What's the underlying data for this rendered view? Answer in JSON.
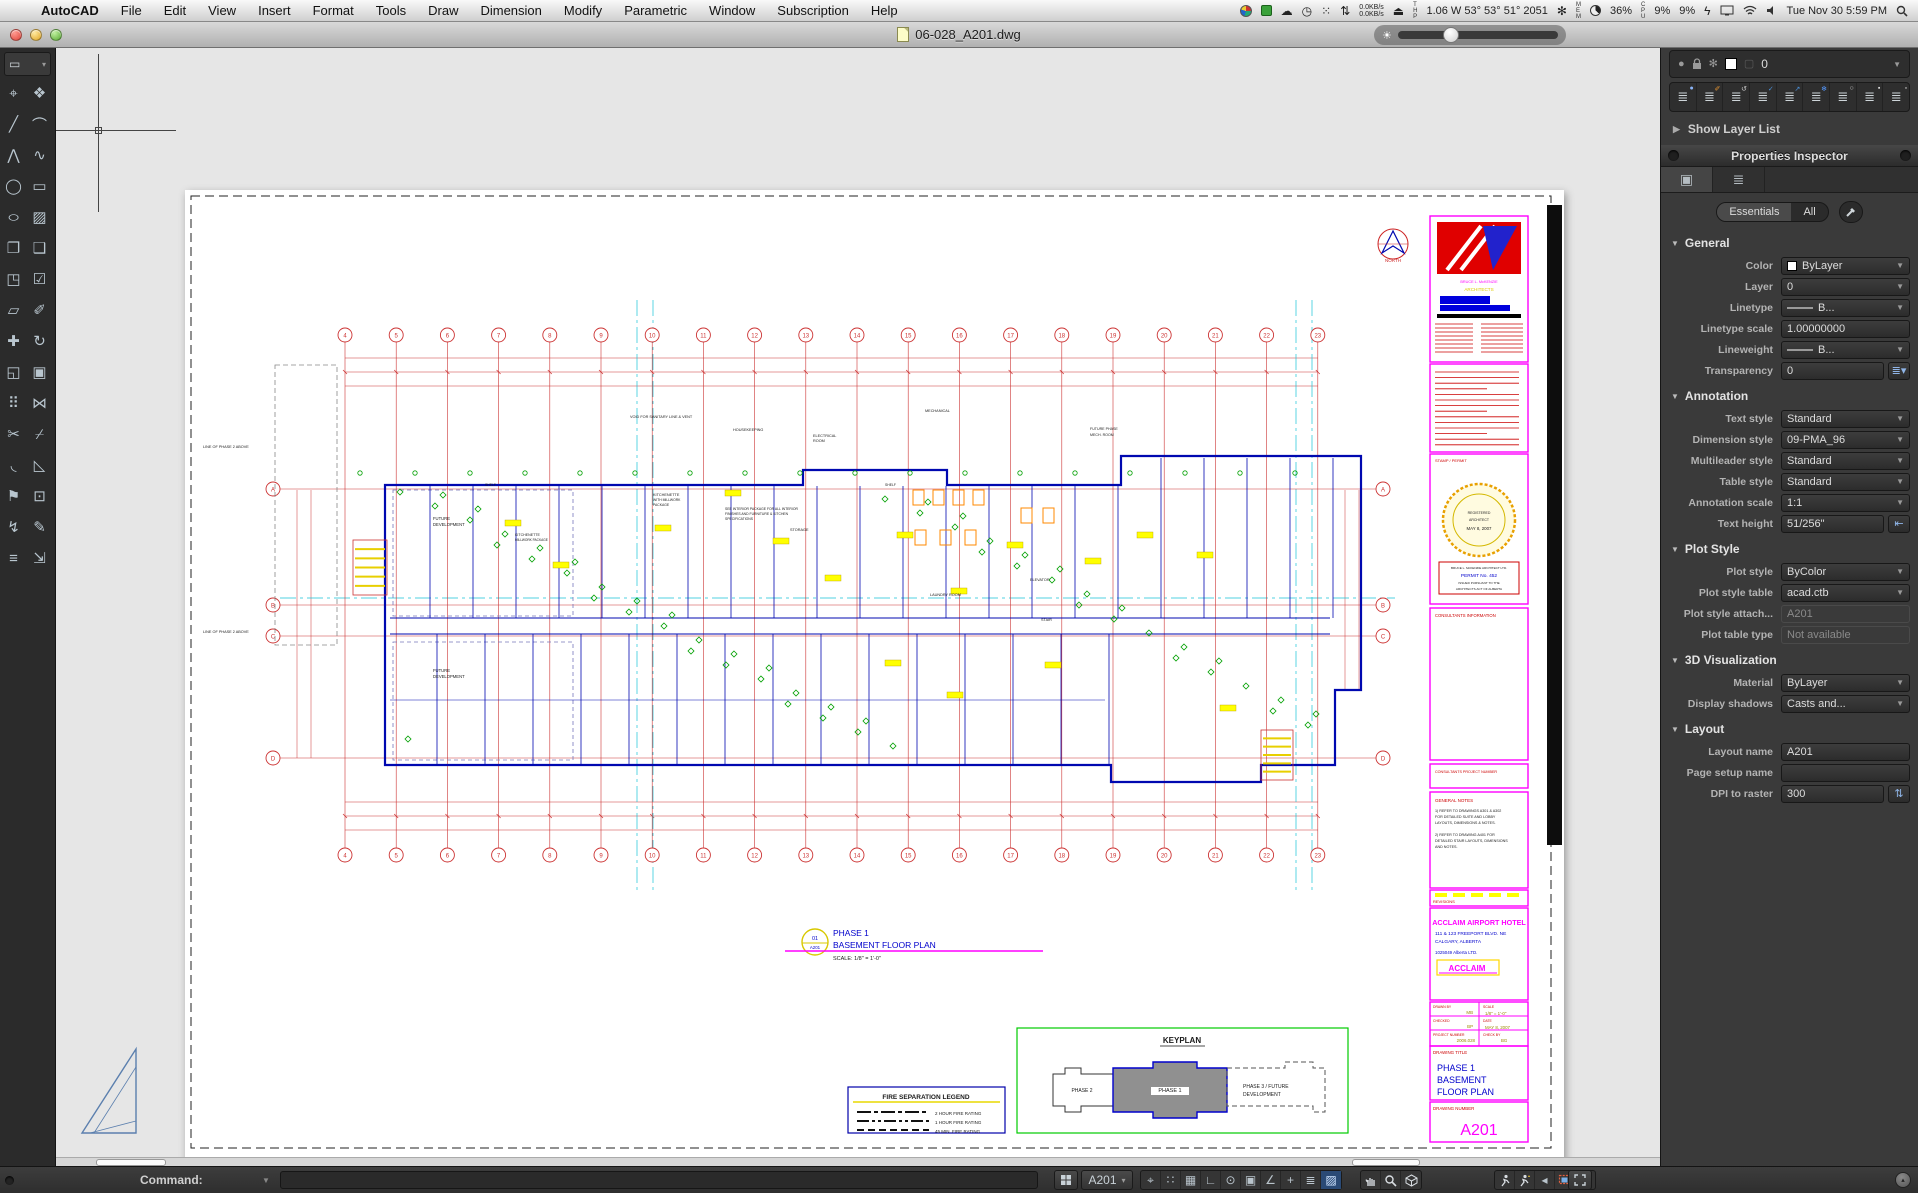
{
  "menu_bar": {
    "apple": "",
    "items": [
      "AutoCAD",
      "File",
      "Edit",
      "View",
      "Insert",
      "Format",
      "Tools",
      "Draw",
      "Dimension",
      "Modify",
      "Parametric",
      "Window",
      "Subscription",
      "Help"
    ],
    "status": {
      "net_up": "0.0KB/s",
      "net_down": "0.0KB/s",
      "sensor_prefix": "THP",
      "sensor_readout": "1.06 W 53° 53° 51° 2051",
      "mem_prefix": "MEM",
      "mem_pct": "36%",
      "cpu_prefix": "CPU",
      "cpu_pct": "9%",
      "gpu_pct": "9%",
      "clock": "Tue Nov 30  5:59 PM"
    }
  },
  "window": {
    "title": "06-028_A201.dwg"
  },
  "tool_palette": {
    "tools": [
      {
        "n": "point-tool",
        "g": "⌖"
      },
      {
        "n": "block-tool",
        "g": "❖"
      },
      {
        "n": "line-tool",
        "g": "╱"
      },
      {
        "n": "arc-tool",
        "g": "⌒"
      },
      {
        "n": "polyline-tool",
        "g": "⋀"
      },
      {
        "n": "spline-tool",
        "g": "∿"
      },
      {
        "n": "circle-tool",
        "g": "◯"
      },
      {
        "n": "rectangle-tool",
        "g": "▭"
      },
      {
        "n": "ellipse-tool",
        "g": "○"
      },
      {
        "n": "hatch-tool",
        "g": "▨"
      },
      {
        "n": "copy-tool",
        "g": "❐"
      },
      {
        "n": "duplicate-tool",
        "g": "❑"
      },
      {
        "n": "stamp-tool",
        "g": "◳"
      },
      {
        "n": "stamp-check-tool",
        "g": "☑"
      },
      {
        "n": "box-3d-tool",
        "g": "▱"
      },
      {
        "n": "paintbrush-tool",
        "g": "✐"
      },
      {
        "n": "move-tool",
        "g": "✚"
      },
      {
        "n": "rotate-tool",
        "g": "↻"
      },
      {
        "n": "scale-tool",
        "g": "◱"
      },
      {
        "n": "offset-tool",
        "g": "▣"
      },
      {
        "n": "array-tool",
        "g": "⠿"
      },
      {
        "n": "mirror-tool",
        "g": "⋈"
      },
      {
        "n": "trim-tool",
        "g": "✂"
      },
      {
        "n": "break-tool",
        "g": "⌿"
      },
      {
        "n": "fillet-tool",
        "g": "◟"
      },
      {
        "n": "chamfer-tool",
        "g": "◺"
      },
      {
        "n": "flag-tool",
        "g": "⚑"
      },
      {
        "n": "pickbox-tool",
        "g": "⊡"
      },
      {
        "n": "explode-tool",
        "g": "↯"
      },
      {
        "n": "pencil-tool",
        "g": "✎"
      },
      {
        "n": "measure-tool",
        "g": "≡"
      },
      {
        "n": "extend-tool",
        "g": "⇲"
      }
    ]
  },
  "layers_panel": {
    "title": "Layers",
    "current_layer": "0",
    "show_layer_list": "Show Layer List",
    "buttons": [
      {
        "n": "layer-new",
        "ov": "●",
        "c": "#8ab4f8"
      },
      {
        "n": "layer-walk",
        "ov": "✐",
        "c": "#e09030"
      },
      {
        "n": "layer-previous",
        "ov": "↺",
        "c": "#cccccc"
      },
      {
        "n": "layer-make-current",
        "ov": "✓",
        "c": "#4a90d9"
      },
      {
        "n": "layer-match",
        "ov": "↗",
        "c": "#4a90d9"
      },
      {
        "n": "layer-freeze",
        "ov": "❄",
        "c": "#5599ff"
      },
      {
        "n": "layer-off",
        "ov": "○",
        "c": "#cccccc"
      },
      {
        "n": "layer-lock",
        "ov": "▪",
        "c": "#dddddd"
      },
      {
        "n": "layer-unlock",
        "ov": "▫",
        "c": "#dddddd"
      }
    ]
  },
  "properties_inspector": {
    "title": "Properties Inspector",
    "filter": {
      "essentials": "Essentials",
      "all": "All"
    },
    "sections": [
      {
        "title": "General",
        "rows": [
          {
            "label": "Color",
            "value": "ByLayer",
            "control": "select",
            "swatch": "#ffffff"
          },
          {
            "label": "Layer",
            "value": "0",
            "control": "select"
          },
          {
            "label": "Linetype",
            "value": "B...",
            "control": "select",
            "line": true
          },
          {
            "label": "Linetype scale",
            "value": "1.00000000",
            "control": "input"
          },
          {
            "label": "Lineweight",
            "value": "B...",
            "control": "select",
            "line": true
          },
          {
            "label": "Transparency",
            "value": "0",
            "control": "input-combo"
          }
        ]
      },
      {
        "title": "Annotation",
        "rows": [
          {
            "label": "Text style",
            "value": "Standard",
            "control": "select"
          },
          {
            "label": "Dimension style",
            "value": "09-PMA_96",
            "control": "select"
          },
          {
            "label": "Multileader style",
            "value": "Standard",
            "control": "select"
          },
          {
            "label": "Table style",
            "value": "Standard",
            "control": "select"
          },
          {
            "label": "Annotation scale",
            "value": "1:1",
            "control": "select"
          },
          {
            "label": "Text height",
            "value": "51/256\"",
            "control": "input-icon"
          }
        ]
      },
      {
        "title": "Plot Style",
        "rows": [
          {
            "label": "Plot style",
            "value": "ByColor",
            "control": "select"
          },
          {
            "label": "Plot style table",
            "value": "acad.ctb",
            "control": "select"
          },
          {
            "label": "Plot style attach...",
            "value": "A201",
            "control": "input",
            "disabled": true
          },
          {
            "label": "Plot table type",
            "value": "Not available",
            "control": "input",
            "disabled": true
          }
        ]
      },
      {
        "title": "3D Visualization",
        "rows": [
          {
            "label": "Material",
            "value": "ByLayer",
            "control": "select"
          },
          {
            "label": "Display shadows",
            "value": "Casts and...",
            "control": "select"
          }
        ]
      },
      {
        "title": "Layout",
        "rows": [
          {
            "label": "Layout name",
            "value": "A201",
            "control": "input"
          },
          {
            "label": "Page setup name",
            "value": "",
            "control": "input"
          },
          {
            "label": "DPI to raster",
            "value": "300",
            "control": "input-stepper"
          }
        ]
      }
    ]
  },
  "command_bar": {
    "prompt": "Command:",
    "input_value": ""
  },
  "status_bar": {
    "layout_name": "A201",
    "toggles": [
      {
        "n": "snap-toggle",
        "g": "⌖"
      },
      {
        "n": "grid-dots-toggle",
        "g": "∷"
      },
      {
        "n": "grid-toggle",
        "g": "▦"
      },
      {
        "n": "ortho-toggle",
        "g": "∟"
      },
      {
        "n": "polar-toggle",
        "g": "⊙"
      },
      {
        "n": "osnap-toggle",
        "g": "▣"
      },
      {
        "n": "otrack-toggle",
        "g": "∠"
      },
      {
        "n": "dyn-input-toggle",
        "g": "+"
      },
      {
        "n": "lineweight-toggle",
        "g": "≣"
      },
      {
        "n": "transparency-toggle",
        "g": "▨",
        "active": true
      }
    ]
  },
  "sheet": {
    "grid": {
      "columns": [
        "4",
        "5",
        "6",
        "7",
        "8",
        "9",
        "10",
        "11",
        "12",
        "13",
        "14",
        "15",
        "16",
        "17",
        "18",
        "19",
        "20",
        "21",
        "22",
        "23"
      ],
      "rows": [
        "A",
        "B",
        "C",
        "D"
      ]
    },
    "texts": [
      {
        "x": 1294,
        "y": 735,
        "t": "ACCLAIM AIRPORT HOTEL",
        "c": "#ff00ff",
        "s": 7.2,
        "a": "middle",
        "b": 1
      },
      {
        "x": 1250,
        "y": 745,
        "t": "111 & 123 FREEPORT BLVD. NE",
        "c": "#0000cc",
        "s": 4.8
      },
      {
        "x": 1250,
        "y": 753,
        "t": "CALGARY, ALBERTA",
        "c": "#0000cc",
        "s": 4.8
      },
      {
        "x": 1250,
        "y": 764,
        "t": "1025049 Alberta LTD.",
        "c": "#0000cc",
        "s": 4.4
      },
      {
        "x": 1282,
        "y": 781,
        "t": "ACCLAIM",
        "c": "#ff00ff",
        "s": 8,
        "a": "middle",
        "b": 1
      },
      {
        "x": 1248,
        "y": 818,
        "t": "DRAWN BY",
        "c": "#cc0000",
        "s": 3.4
      },
      {
        "x": 1288,
        "y": 824,
        "t": "MB",
        "c": "#9a8a00",
        "s": 4.4,
        "a": "end"
      },
      {
        "x": 1298,
        "y": 818,
        "t": "SCALE",
        "c": "#cc0000",
        "s": 3.4
      },
      {
        "x": 1300,
        "y": 825,
        "t": "1/8\" = 1'-0\"",
        "c": "#9a8a00",
        "s": 4.4
      },
      {
        "x": 1248,
        "y": 832,
        "t": "CHECKED",
        "c": "#cc0000",
        "s": 3.4
      },
      {
        "x": 1288,
        "y": 838,
        "t": "BP",
        "c": "#9a8a00",
        "s": 4.4,
        "a": "end"
      },
      {
        "x": 1298,
        "y": 832,
        "t": "DATE",
        "c": "#cc0000",
        "s": 3.4
      },
      {
        "x": 1300,
        "y": 839,
        "t": "MAY 8, 2007",
        "c": "#9a8a00",
        "s": 4.4
      },
      {
        "x": 1248,
        "y": 846,
        "t": "PROJECT NUMBER",
        "c": "#cc0000",
        "s": 3.4
      },
      {
        "x": 1290,
        "y": 852,
        "t": "2006.028",
        "c": "#9a8a00",
        "s": 4.4,
        "a": "end"
      },
      {
        "x": 1298,
        "y": 846,
        "t": "CHECK BY",
        "c": "#cc0000",
        "s": 3.4
      },
      {
        "x": 1316,
        "y": 852,
        "t": "BG",
        "c": "#9a8a00",
        "s": 4.4
      },
      {
        "x": 1248,
        "y": 864,
        "t": "DRAWING TITLE",
        "c": "#cc0000",
        "s": 4.4
      },
      {
        "x": 1252,
        "y": 881,
        "t": "PHASE 1",
        "c": "#0000cc",
        "s": 9
      },
      {
        "x": 1252,
        "y": 893,
        "t": "BASEMENT",
        "c": "#0000cc",
        "s": 9
      },
      {
        "x": 1252,
        "y": 905,
        "t": "FLOOR PLAN",
        "c": "#0000cc",
        "s": 9
      },
      {
        "x": 1248,
        "y": 920,
        "t": "DRAWING NUMBER",
        "c": "#cc0000",
        "s": 4.4
      },
      {
        "x": 1294,
        "y": 945,
        "t": "A201",
        "c": "#ff00ff",
        "s": 16,
        "a": "middle"
      },
      {
        "x": 1248,
        "y": 713,
        "t": "REVISIONS",
        "c": "#cc0000",
        "s": 4
      },
      {
        "x": 1250,
        "y": 427,
        "t": "CONSULTANTS INFORMATION",
        "c": "#cc0000",
        "s": 4.2
      },
      {
        "x": 1250,
        "y": 583,
        "t": "CONSULTANTS PROJECT NUMBER",
        "c": "#cc0000",
        "s": 3.7
      },
      {
        "x": 1250,
        "y": 612,
        "t": "GENERAL NOTES",
        "c": "#cc0000",
        "s": 4.5
      },
      {
        "x": 1250,
        "y": 622,
        "t": "1) REFER TO DRAWINGS A301 & A302",
        "s": 3.7
      },
      {
        "x": 1250,
        "y": 628,
        "t": "FOR DETAILED SUITE AND LOBBY",
        "s": 3.7
      },
      {
        "x": 1250,
        "y": 634,
        "t": "LAYOUTS, DIMENSIONS & NOTES.",
        "s": 3.7
      },
      {
        "x": 1250,
        "y": 646,
        "t": "2) REFER TO DRAWING A401 FOR",
        "s": 3.7
      },
      {
        "x": 1250,
        "y": 652,
        "t": "DETAILED STAIR LAYOUTS, DIMENSIONS",
        "s": 3.7
      },
      {
        "x": 1250,
        "y": 658,
        "t": "AND NOTES.",
        "s": 3.7
      },
      {
        "x": 1250,
        "y": 272,
        "t": "STAMP / PERMIT",
        "c": "#cc0000",
        "s": 4
      },
      {
        "x": 1294,
        "y": 324,
        "t": "REGISTERED",
        "s": 3.5,
        "a": "middle"
      },
      {
        "x": 1294,
        "y": 331,
        "t": "ARCHITECT",
        "s": 3.5,
        "a": "middle"
      },
      {
        "x": 1294,
        "y": 340,
        "t": "MAY 8, 2007",
        "s": 4.4,
        "a": "middle"
      },
      {
        "x": 1294,
        "y": 379,
        "t": "BRUCE L. McKENZIE ARCHITECT LTD.",
        "s": 3.1,
        "a": "middle"
      },
      {
        "x": 1294,
        "y": 387,
        "t": "PERMIT No. 452",
        "c": "#0000cc",
        "s": 4.8,
        "a": "middle"
      },
      {
        "x": 1294,
        "y": 394,
        "t": "ISSUED PURSUANT TO THE",
        "s": 3.1,
        "a": "middle"
      },
      {
        "x": 1294,
        "y": 400,
        "t": "ARCHITECTS ACT OF ALBERTA",
        "s": 3.1,
        "a": "middle"
      },
      {
        "x": 1294,
        "y": 93,
        "t": "BRUCE L. McKENZIE",
        "c": "#ff00ff",
        "s": 3.8,
        "a": "middle"
      },
      {
        "x": 1294,
        "y": 101,
        "t": "ARCHITECTS",
        "c": "#ddcc00",
        "s": 4.6,
        "a": "middle"
      },
      {
        "x": 1208,
        "y": 72,
        "t": "NORTH",
        "c": "#cc2222",
        "s": 4.5,
        "a": "middle"
      },
      {
        "x": 648,
        "y": 746,
        "t": "PHASE 1",
        "c": "#0000cc",
        "s": 8.5
      },
      {
        "x": 648,
        "y": 758,
        "t": "BASEMENT FLOOR PLAN",
        "c": "#0000cc",
        "s": 8.5
      },
      {
        "x": 648,
        "y": 770,
        "t": "SCALE: 1/8\" = 1'-0\"",
        "s": 5.5
      },
      {
        "x": 630,
        "y": 750,
        "t": "01",
        "c": "#0000cc",
        "s": 5.5,
        "a": "middle"
      },
      {
        "x": 630,
        "y": 759,
        "t": "A201",
        "c": "#0000cc",
        "s": 4.4,
        "a": "middle"
      },
      {
        "x": 741,
        "y": 909,
        "t": "FIRE SEPARATION LEGEND",
        "s": 6.5,
        "a": "middle",
        "b": 1
      },
      {
        "x": 750,
        "y": 925,
        "t": "2 HOUR FIRE RATING",
        "s": 4.5
      },
      {
        "x": 750,
        "y": 934,
        "t": "1 HOUR FIRE RATING",
        "s": 4.5
      },
      {
        "x": 750,
        "y": 943,
        "t": "45 MIN. FIRE RATING",
        "s": 4.5
      },
      {
        "x": 997,
        "y": 853,
        "t": "KEYPLAN",
        "s": 8,
        "a": "middle",
        "b": 1
      },
      {
        "x": 897,
        "y": 902,
        "t": "PHASE 2",
        "s": 5,
        "a": "middle"
      },
      {
        "x": 985,
        "y": 902,
        "t": "PHASE 1",
        "s": 5.5,
        "a": "middle"
      },
      {
        "x": 1058,
        "y": 898,
        "t": "PHASE 3 / FUTURE",
        "s": 5
      },
      {
        "x": 1058,
        "y": 906,
        "t": "DEVELOPMENT",
        "s": 5
      },
      {
        "x": 18,
        "y": 258,
        "t": "LINE OF PHASE 2 ABOVE",
        "s": 3.8
      },
      {
        "x": 18,
        "y": 443,
        "t": "LINE OF PHASE 2 ABOVE",
        "s": 3.8
      },
      {
        "x": 248,
        "y": 330,
        "t": "FUTURE",
        "s": 4.2
      },
      {
        "x": 248,
        "y": 336,
        "t": "DEVELOPMENT",
        "s": 4.2
      },
      {
        "x": 248,
        "y": 482,
        "t": "FUTURE",
        "s": 4.2
      },
      {
        "x": 248,
        "y": 488,
        "t": "DEVELOPMENT",
        "s": 4.2
      },
      {
        "x": 445,
        "y": 228,
        "t": "VOID FOR SANITARY LINE & VENT",
        "s": 3.8
      },
      {
        "x": 468,
        "y": 306,
        "t": "KITCHENETTE",
        "s": 3.8
      },
      {
        "x": 468,
        "y": 311,
        "t": "WITH MILLWORK",
        "s": 3.4
      },
      {
        "x": 468,
        "y": 316,
        "t": "PACKAGE",
        "s": 3.4
      },
      {
        "x": 330,
        "y": 346,
        "t": "KITCHENETTE",
        "s": 3.6
      },
      {
        "x": 330,
        "y": 351,
        "t": "MILLWORK PACKAGE",
        "s": 3.2
      },
      {
        "x": 548,
        "y": 241,
        "t": "HOUSEKEEPING",
        "s": 3.8
      },
      {
        "x": 628,
        "y": 247,
        "t": "ELECTRICAL",
        "s": 3.8
      },
      {
        "x": 628,
        "y": 252,
        "t": "ROOM",
        "s": 3.8
      },
      {
        "x": 740,
        "y": 222,
        "t": "MECHANICAL",
        "s": 3.8
      },
      {
        "x": 905,
        "y": 240,
        "t": "FUTURE PHASE",
        "s": 3.6
      },
      {
        "x": 905,
        "y": 246,
        "t": "MECH. ROOM",
        "s": 3.6
      },
      {
        "x": 605,
        "y": 341,
        "t": "STORAGE",
        "s": 3.8
      },
      {
        "x": 540,
        "y": 320,
        "t": "SEE INTERIOR PACKAGE FOR ALL INTERIOR",
        "s": 3.4
      },
      {
        "x": 540,
        "y": 325,
        "t": "FINISHES AND FURNITURE & KITCHEN",
        "s": 3.4
      },
      {
        "x": 540,
        "y": 330,
        "t": "SPECIFICATIONS",
        "s": 3.4
      },
      {
        "x": 745,
        "y": 406,
        "t": "LAUNDRY ROOM",
        "s": 3.8
      },
      {
        "x": 845,
        "y": 391,
        "t": "ELEVATOR",
        "s": 3.8
      },
      {
        "x": 856,
        "y": 431,
        "t": "STAIR",
        "s": 3.8
      },
      {
        "x": 300,
        "y": 296,
        "t": "SHELF",
        "s": 3.4
      },
      {
        "x": 700,
        "y": 296,
        "t": "SHELF",
        "s": 3.4
      }
    ]
  }
}
